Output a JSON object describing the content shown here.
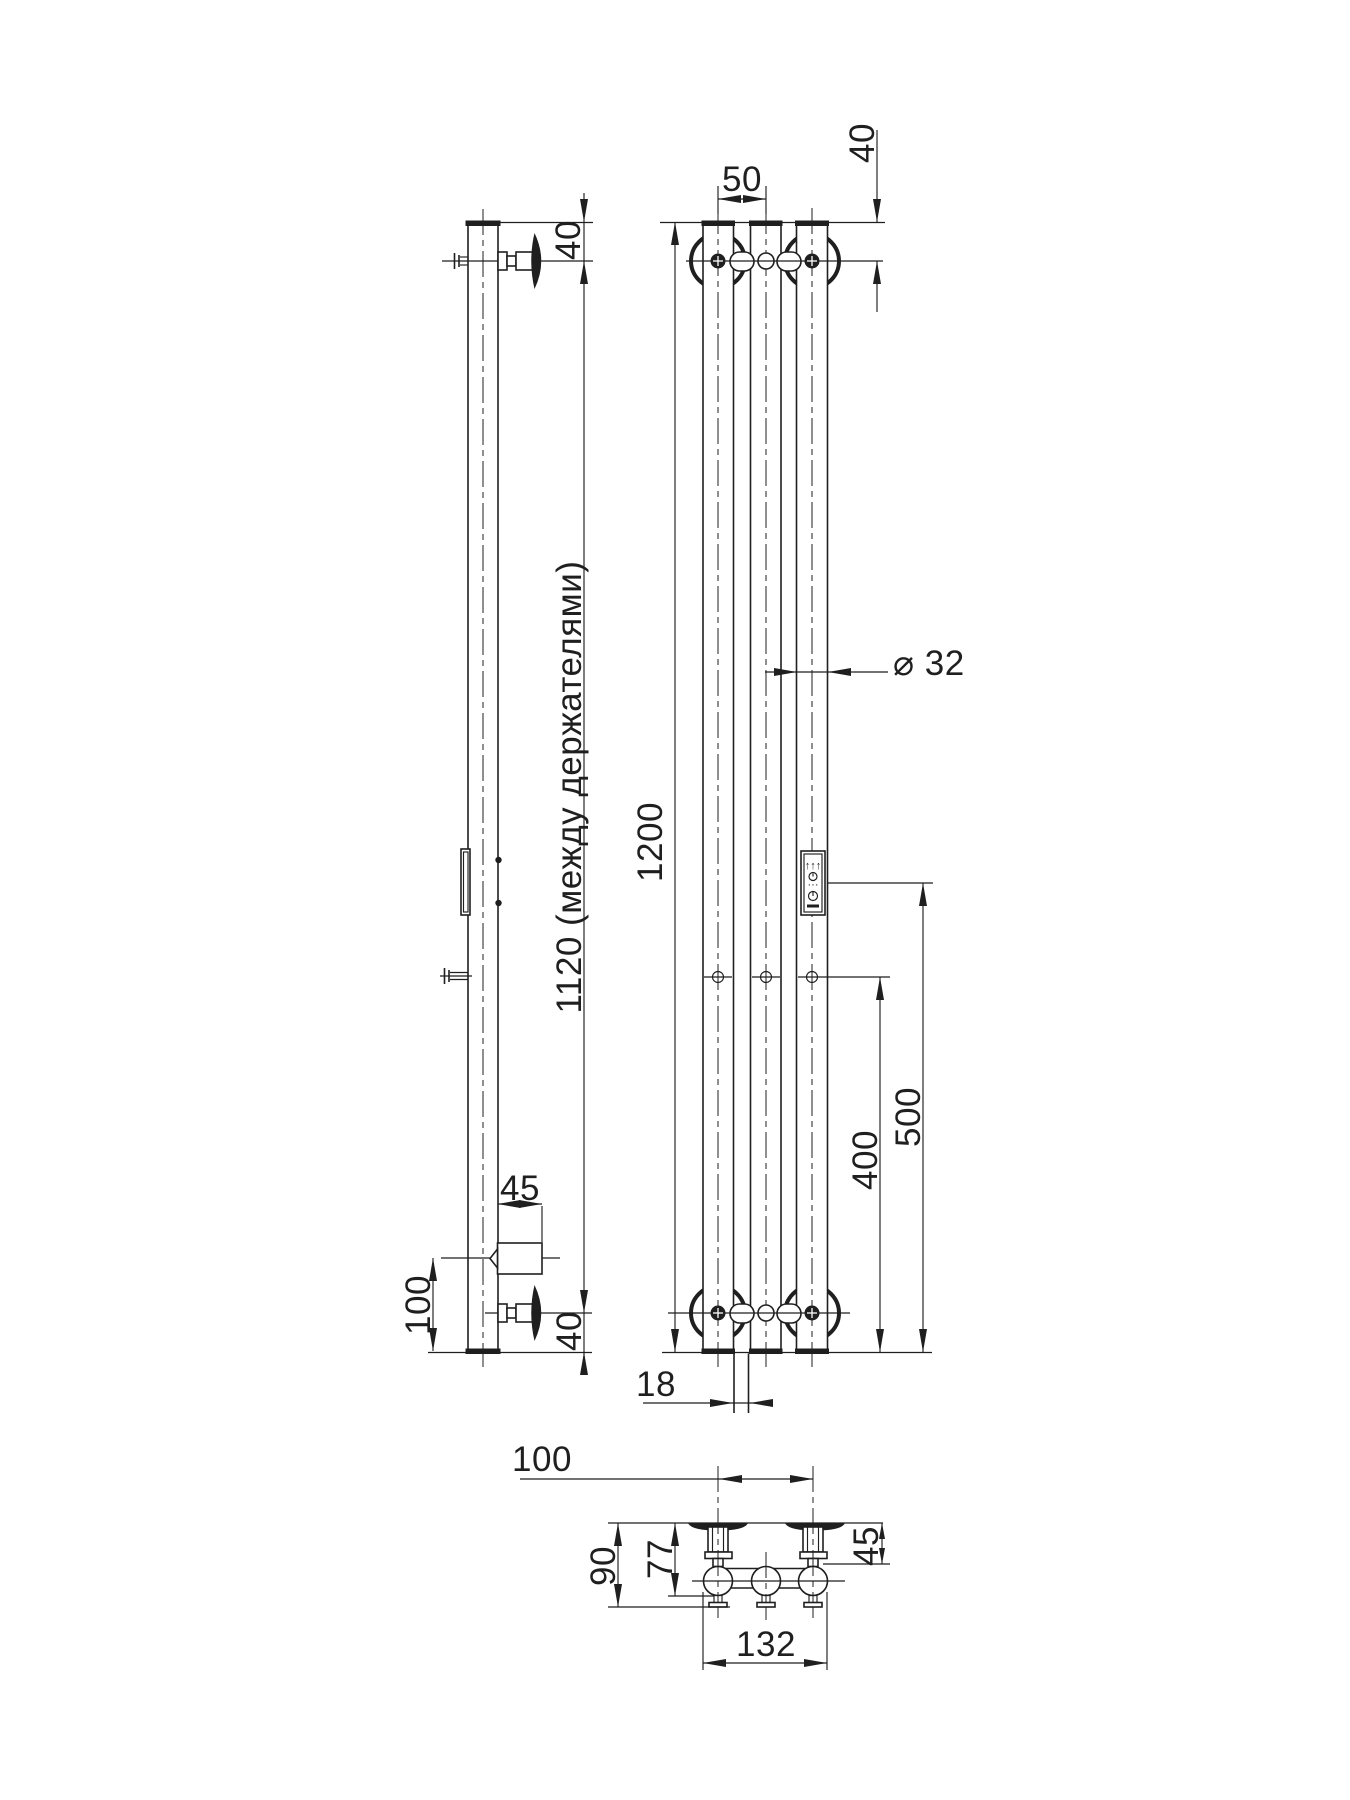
{
  "page": {
    "background": "#ffffff",
    "line_color": "#1f1f1f",
    "description": "Technical dimension drawing of a wall-mounted vertical electric towel rail: side view, front view and plan view"
  },
  "dims": {
    "side_top_offset": "40",
    "between_holders": "1120 (между держателями)",
    "ten_width": "45",
    "ten_bottom_height": "100",
    "side_bottom_offset": "40",
    "tube_pitch": "50",
    "front_top_offset": "40",
    "overall_height": "1200",
    "tube_diameter": "⌀ 32",
    "panel_center_height": "500",
    "mid_holes_height": "400",
    "riser_width": "18",
    "holder_pitch": "100",
    "depth_overall": "90",
    "depth_to_tube": "77",
    "holder_offset": "45",
    "overall_width": "132"
  },
  "panel": {
    "icons": [
      "triple-up-arrows",
      "timer-dial",
      "dots-indicator",
      "power-dial",
      "heat-bar"
    ],
    "arrows_glyph": "↑↑↑",
    "dots_glyph": "···"
  }
}
